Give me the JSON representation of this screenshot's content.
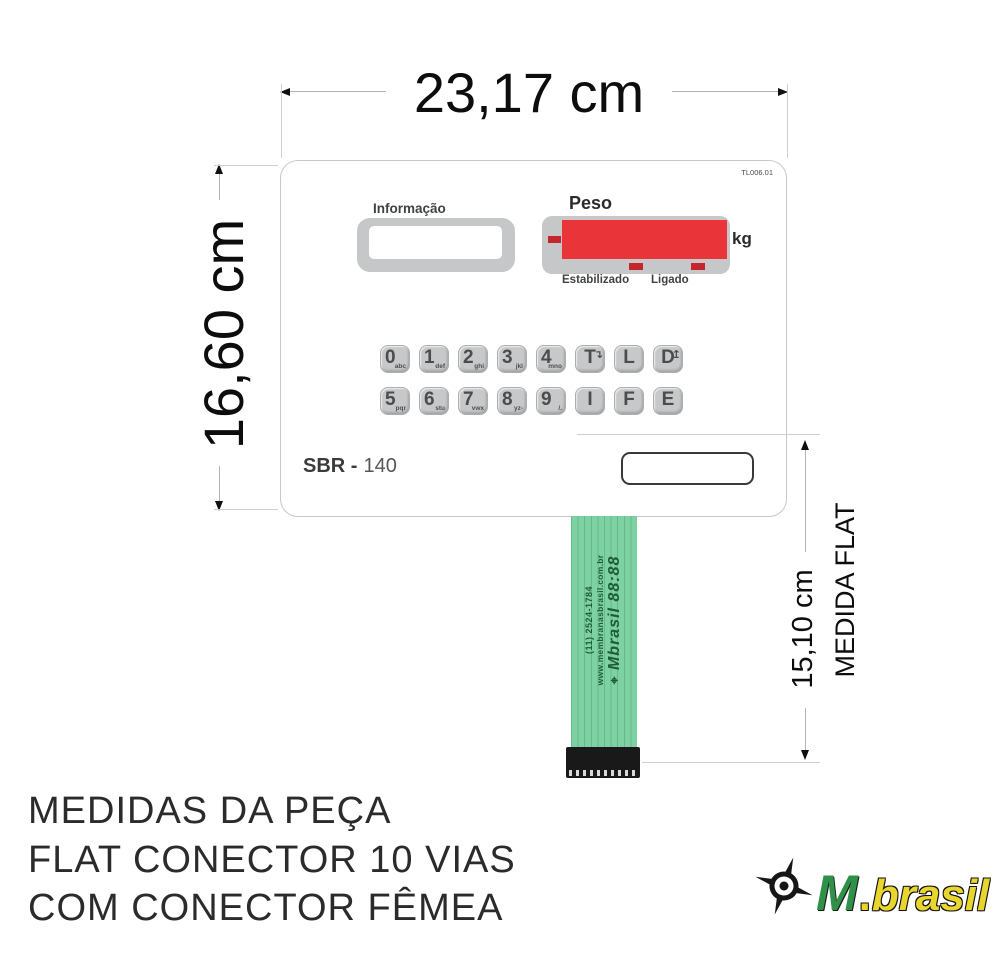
{
  "measurements": {
    "width": "23,17 cm",
    "height": "16,60 cm",
    "flat_length": "15,10 cm",
    "flat_caption": "MEDIDA FLAT"
  },
  "panel": {
    "part_code": "TL006.01",
    "info_label": "Informação",
    "weight_label": "Peso",
    "unit_label": "kg",
    "stabilized_label": "Estabilizado",
    "on_label": "Ligado",
    "model_prefix": "SBR -",
    "model_number": "140",
    "keys_row1": [
      {
        "label": "0",
        "sub": "abc"
      },
      {
        "label": "1",
        "sub": "def"
      },
      {
        "label": "2",
        "sub": "ghi"
      },
      {
        "label": "3",
        "sub": "jkl"
      },
      {
        "label": "4",
        "sub": "mno"
      },
      {
        "label": "T",
        "icon": "↴",
        "icon_name": "tare-arrow-icon"
      },
      {
        "label": "L"
      },
      {
        "label": "D",
        "icon": "↥",
        "icon_name": "enter-arrow-icon"
      }
    ],
    "keys_row2": [
      {
        "label": "5",
        "sub": "pqr"
      },
      {
        "label": "6",
        "sub": "stu"
      },
      {
        "label": "7",
        "sub": "vwx"
      },
      {
        "label": "8",
        "sub": "yz-"
      },
      {
        "label": "9",
        "sub": "/."
      },
      {
        "label": "I"
      },
      {
        "label": "F"
      },
      {
        "label": "E"
      }
    ]
  },
  "cable": {
    "brand_icon": "⌖",
    "brand": "Mbrasil 88:88",
    "website": "www.membranasbrasil.com.br",
    "phone": "(11) 2524-1784"
  },
  "footer": {
    "line1": "MEDIDAS DA PEÇA",
    "line2": "FLAT CONECTOR 10 VIAS",
    "line3": "COM CONECTOR FÊMEA"
  },
  "logo": {
    "m": "M",
    "dot": ".",
    "brasil": "brasil"
  },
  "colors": {
    "display_red": "#e9343a",
    "indicator_red": "#c4262c",
    "frame_gray": "#c6c7c9",
    "cable_green": "#7ed1a2",
    "cable_text_green": "#1d5c38",
    "logo_green": "#2f9147",
    "logo_yellow": "#e8d52e"
  }
}
